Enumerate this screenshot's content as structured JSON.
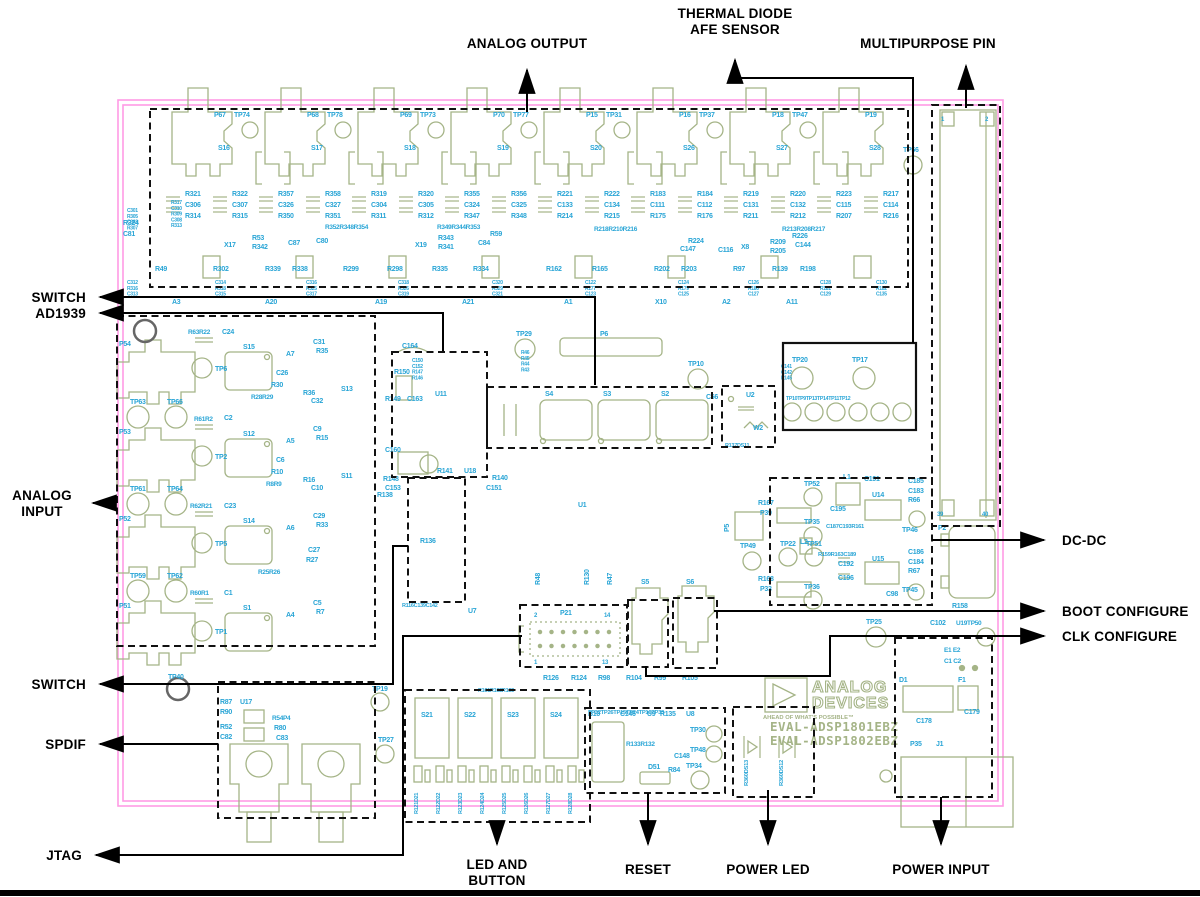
{
  "callouts": {
    "analog_output": "ANALOG OUTPUT",
    "thermal_line1": "THERMAL DIODE",
    "thermal_line2": "AFE SENSOR",
    "multipurpose_pin": "MULTIPURPOSE PIN",
    "switch_top": "SWITCH",
    "ad1939": "AD1939",
    "analog_input_line1": "ANALOG",
    "analog_input_line2": "INPUT",
    "switch_mid": "SWITCH",
    "spdif": "SPDIF",
    "jtag": "JTAG",
    "dcdc": "DC-DC",
    "boot_configure": "BOOT CONFIGURE",
    "clk_configure": "CLK CONFIGURE",
    "led_button_line1": "LED AND",
    "led_button_line2": "BUTTON",
    "reset": "RESET",
    "power_led": "POWER LED",
    "power_input": "POWER INPUT"
  },
  "logo": {
    "line1": "ANALOG",
    "line2": "DEVICES",
    "tagline": "AHEAD OF WHAT'S POSSIBLE™",
    "eval1": "EVAL-ADSP1801EBZ",
    "eval2": "EVAL-ADSP1802EBZ"
  },
  "colors": {
    "board_outline": "#ff9be5",
    "silkscreen": "#a5b487",
    "designator": "#29a5d6",
    "callout": "#000000",
    "mount_hole": "#666666"
  },
  "board": {
    "columns": {
      "x0": 185,
      "dx": 46.5,
      "rows": [
        196,
        207,
        218
      ],
      "sets": [
        [
          "R321",
          "C306",
          "R314"
        ],
        [
          "R322",
          "C307",
          "R315"
        ],
        [
          "R357",
          "C326",
          "R350"
        ],
        [
          "R358",
          "C327",
          "R351"
        ],
        [
          "R319",
          "C304",
          "R311"
        ],
        [
          "R320",
          "C305",
          "R312"
        ],
        [
          "R355",
          "C324",
          "R347"
        ],
        [
          "R356",
          "C325",
          "R348"
        ],
        [
          "R221",
          "C133",
          "R214"
        ],
        [
          "R222",
          "C134",
          "R215"
        ],
        [
          "R183",
          "C111",
          "R175"
        ],
        [
          "R184",
          "C112",
          "R176"
        ],
        [
          "R219",
          "C131",
          "R211"
        ],
        [
          "R220",
          "C132",
          "R212"
        ],
        [
          "R223",
          "C115",
          "R207"
        ],
        [
          "R217",
          "C114",
          "R216"
        ]
      ]
    },
    "top_jacks": {
      "p": [
        "P67",
        "P68",
        "P69",
        "P70",
        "P15",
        "P16",
        "P18",
        "P19"
      ],
      "tp": [
        "TP74",
        "TP78",
        "TP73",
        "TP77",
        "TP31",
        "TP37",
        "TP47"
      ],
      "s": [
        "S16",
        "S17",
        "S18",
        "S19",
        "S20",
        "S26",
        "S27",
        "S28"
      ]
    },
    "labels": [
      [
        123,
        225,
        "R324"
      ],
      [
        123,
        236,
        "C81"
      ],
      [
        224,
        247,
        "X17"
      ],
      [
        415,
        247,
        "X19"
      ],
      [
        741,
        249,
        "X8"
      ],
      [
        325,
        229,
        "R352R348R354",
        6.5
      ],
      [
        437,
        229,
        "R349R344R353",
        6.5
      ],
      [
        594,
        231,
        "R218R210R216",
        6.5
      ],
      [
        782,
        231,
        "R213R208R217",
        6.5
      ],
      [
        252,
        240,
        "R53"
      ],
      [
        252,
        249,
        "R342"
      ],
      [
        288,
        245,
        "C87"
      ],
      [
        316,
        243,
        "C80"
      ],
      [
        438,
        240,
        "R343"
      ],
      [
        438,
        249,
        "R341"
      ],
      [
        478,
        245,
        "C84"
      ],
      [
        490,
        236,
        "R59"
      ],
      [
        688,
        243,
        "R224"
      ],
      [
        680,
        251,
        "C147"
      ],
      [
        718,
        252,
        "C116"
      ],
      [
        770,
        244,
        "R209"
      ],
      [
        770,
        253,
        "R205"
      ],
      [
        795,
        247,
        "C144"
      ],
      [
        792,
        238,
        "R226"
      ],
      [
        155,
        271,
        "R49"
      ],
      [
        213,
        271,
        "R302"
      ],
      [
        265,
        271,
        "R339"
      ],
      [
        292,
        271,
        "R338"
      ],
      [
        343,
        271,
        "R299"
      ],
      [
        387,
        271,
        "R298"
      ],
      [
        432,
        271,
        "R335"
      ],
      [
        473,
        271,
        "R334"
      ],
      [
        546,
        271,
        "R162"
      ],
      [
        592,
        271,
        "R165"
      ],
      [
        654,
        271,
        "R202"
      ],
      [
        681,
        271,
        "R203"
      ],
      [
        733,
        271,
        "R97"
      ],
      [
        772,
        271,
        "R139"
      ],
      [
        800,
        271,
        "R198"
      ],
      [
        172,
        304,
        "A3"
      ],
      [
        265,
        304,
        "A20"
      ],
      [
        375,
        304,
        "A19"
      ],
      [
        462,
        304,
        "A21"
      ],
      [
        564,
        304,
        "A1"
      ],
      [
        655,
        304,
        "X10"
      ],
      [
        722,
        304,
        "A2"
      ],
      [
        786,
        304,
        "A11"
      ],
      [
        188,
        334,
        "R63R22",
        6.5
      ],
      [
        222,
        334,
        "C24"
      ],
      [
        119,
        346,
        "P54"
      ],
      [
        215,
        371,
        "TP6"
      ],
      [
        243,
        349,
        "S15"
      ],
      [
        286,
        356,
        "A7"
      ],
      [
        313,
        344,
        "C31"
      ],
      [
        316,
        353,
        "R35"
      ],
      [
        276,
        375,
        "C26"
      ],
      [
        271,
        387,
        "R30"
      ],
      [
        251,
        399,
        "R28R29",
        6.5
      ],
      [
        303,
        395,
        "R36"
      ],
      [
        311,
        403,
        "C32"
      ],
      [
        341,
        391,
        "S13"
      ],
      [
        194,
        421,
        "R61R2",
        6.5
      ],
      [
        224,
        420,
        "C2"
      ],
      [
        119,
        434,
        "P53"
      ],
      [
        215,
        459,
        "TP2"
      ],
      [
        243,
        436,
        "S12"
      ],
      [
        286,
        443,
        "A5"
      ],
      [
        313,
        431,
        "C9"
      ],
      [
        316,
        440,
        "R15"
      ],
      [
        276,
        462,
        "C6"
      ],
      [
        271,
        474,
        "R10"
      ],
      [
        266,
        486,
        "R8R9",
        6.5
      ],
      [
        303,
        482,
        "R16"
      ],
      [
        311,
        490,
        "C10"
      ],
      [
        341,
        478,
        "S11"
      ],
      [
        190,
        508,
        "R62R21",
        6.5
      ],
      [
        224,
        508,
        "C23"
      ],
      [
        119,
        521,
        "P52"
      ],
      [
        215,
        546,
        "TP5"
      ],
      [
        243,
        523,
        "S14"
      ],
      [
        286,
        530,
        "A6"
      ],
      [
        313,
        518,
        "C29"
      ],
      [
        316,
        527,
        "R33"
      ],
      [
        308,
        552,
        "C27"
      ],
      [
        306,
        562,
        "R27"
      ],
      [
        258,
        574,
        "R25R26",
        6.5
      ],
      [
        190,
        595,
        "R60R1",
        6.5
      ],
      [
        224,
        595,
        "C1"
      ],
      [
        119,
        608,
        "P51"
      ],
      [
        215,
        634,
        "TP1"
      ],
      [
        243,
        610,
        "S1"
      ],
      [
        286,
        617,
        "A4"
      ],
      [
        313,
        605,
        "C5"
      ],
      [
        316,
        614,
        "R7"
      ],
      [
        130,
        404,
        "TP63"
      ],
      [
        167,
        404,
        "TP66"
      ],
      [
        130,
        491,
        "TP61"
      ],
      [
        167,
        491,
        "TP64"
      ],
      [
        130,
        578,
        "TP59"
      ],
      [
        167,
        578,
        "TP62"
      ],
      [
        168,
        679,
        "TP40"
      ],
      [
        516,
        336,
        "TP29"
      ],
      [
        600,
        336,
        "P6"
      ],
      [
        578,
        507,
        "U1"
      ],
      [
        492,
        480,
        "R140"
      ],
      [
        486,
        490,
        "C151"
      ],
      [
        688,
        366,
        "TP10"
      ],
      [
        903,
        152,
        "TP56"
      ],
      [
        941,
        121,
        "1",
        6
      ],
      [
        985,
        121,
        "2",
        6
      ],
      [
        937,
        516,
        "39",
        6
      ],
      [
        982,
        516,
        "40",
        6
      ],
      [
        938,
        530,
        "P2"
      ],
      [
        402,
        348,
        "C164"
      ],
      [
        435,
        396,
        "U11"
      ],
      [
        394,
        374,
        "R150"
      ],
      [
        385,
        401,
        "R149"
      ],
      [
        407,
        401,
        "C163"
      ],
      [
        385,
        452,
        "C160"
      ],
      [
        383,
        481,
        "R148"
      ],
      [
        385,
        490,
        "C153"
      ],
      [
        437,
        473,
        "R141"
      ],
      [
        464,
        473,
        "U18"
      ],
      [
        377,
        497,
        "R138"
      ],
      [
        545,
        396,
        "S4"
      ],
      [
        603,
        396,
        "S3"
      ],
      [
        661,
        396,
        "S2"
      ],
      [
        706,
        399,
        "C56"
      ],
      [
        746,
        397,
        "U2"
      ],
      [
        753,
        430,
        "W2"
      ],
      [
        725,
        447,
        "R137DS11",
        5.5
      ],
      [
        420,
        543,
        "R136"
      ],
      [
        402,
        607,
        "R116C139C142",
        5.5
      ],
      [
        468,
        613,
        "U7"
      ],
      [
        543,
        680,
        "R126"
      ],
      [
        571,
        680,
        "R124"
      ],
      [
        598,
        680,
        "R98"
      ],
      [
        626,
        680,
        "R104"
      ],
      [
        654,
        680,
        "R99"
      ],
      [
        682,
        680,
        "R105"
      ],
      [
        478,
        692,
        "R101R102R103",
        5.5
      ],
      [
        588,
        714,
        "TP32TP26TP15TP24TP16TP33",
        5.8
      ],
      [
        540,
        585,
        "R48",
        7,
        "v"
      ],
      [
        589,
        585,
        "R130",
        7,
        "v"
      ],
      [
        612,
        585,
        "R47",
        7,
        "v"
      ],
      [
        534,
        617,
        "2",
        6
      ],
      [
        560,
        615,
        "P21"
      ],
      [
        604,
        617,
        "14",
        6
      ],
      [
        534,
        664,
        "1",
        6
      ],
      [
        602,
        664,
        "13",
        6
      ],
      [
        641,
        584,
        "S5"
      ],
      [
        686,
        584,
        "S6"
      ],
      [
        588,
        716,
        "B10"
      ],
      [
        620,
        716,
        "C146"
      ],
      [
        647,
        716,
        "U9"
      ],
      [
        660,
        716,
        "R135"
      ],
      [
        686,
        716,
        "U8"
      ],
      [
        690,
        732,
        "TP30"
      ],
      [
        690,
        752,
        "TP48"
      ],
      [
        626,
        746,
        "R133R132",
        6.5
      ],
      [
        674,
        758,
        "C148"
      ],
      [
        686,
        768,
        "TP34"
      ],
      [
        648,
        769,
        "D51"
      ],
      [
        668,
        772,
        "R84"
      ],
      [
        748,
        786,
        "R360DS13",
        5.8,
        "v"
      ],
      [
        783,
        786,
        "R360DS12",
        5.8,
        "v"
      ],
      [
        421,
        717,
        "S21"
      ],
      [
        464,
        717,
        "S22"
      ],
      [
        507,
        717,
        "S23"
      ],
      [
        550,
        717,
        "S24"
      ],
      [
        418,
        814,
        "R121D21",
        5.5,
        "v"
      ],
      [
        440,
        814,
        "R122D22",
        5.5,
        "v"
      ],
      [
        462,
        814,
        "R123D23",
        5.5,
        "v"
      ],
      [
        484,
        814,
        "R124D24",
        5.5,
        "v"
      ],
      [
        506,
        814,
        "R125D25",
        5.5,
        "v"
      ],
      [
        528,
        814,
        "R126D26",
        5.5,
        "v"
      ],
      [
        550,
        814,
        "R127D27",
        5.5,
        "v"
      ],
      [
        572,
        814,
        "R128D28",
        5.5,
        "v"
      ],
      [
        220,
        704,
        "R87"
      ],
      [
        240,
        704,
        "U17"
      ],
      [
        220,
        714,
        "R90"
      ],
      [
        220,
        729,
        "R52"
      ],
      [
        220,
        739,
        "C82"
      ],
      [
        272,
        720,
        "R54P4",
        6.5
      ],
      [
        274,
        730,
        "R80"
      ],
      [
        276,
        740,
        "C83"
      ],
      [
        378,
        742,
        "TP27"
      ],
      [
        372,
        691,
        "TP19"
      ],
      [
        843,
        479,
        "L1"
      ],
      [
        864,
        481,
        "C191"
      ],
      [
        804,
        486,
        "TP52"
      ],
      [
        758,
        505,
        "R167"
      ],
      [
        760,
        515,
        "P39"
      ],
      [
        830,
        511,
        "C195"
      ],
      [
        872,
        497,
        "U14"
      ],
      [
        908,
        483,
        "C185"
      ],
      [
        908,
        493,
        "C183"
      ],
      [
        908,
        502,
        "R66"
      ],
      [
        826,
        528,
        "C187C193R161",
        5.8
      ],
      [
        804,
        524,
        "TP35"
      ],
      [
        780,
        546,
        "TP22"
      ],
      [
        806,
        546,
        "TP51"
      ],
      [
        800,
        544,
        "L2"
      ],
      [
        818,
        556,
        "R159R163C189",
        5.8
      ],
      [
        838,
        566,
        "C192"
      ],
      [
        838,
        580,
        "C196"
      ],
      [
        872,
        561,
        "U15"
      ],
      [
        908,
        554,
        "C186"
      ],
      [
        908,
        564,
        "C184"
      ],
      [
        908,
        573,
        "R67"
      ],
      [
        886,
        596,
        "C98"
      ],
      [
        902,
        532,
        "TP46"
      ],
      [
        902,
        592,
        "TP45"
      ],
      [
        758,
        581,
        "R168"
      ],
      [
        760,
        591,
        "P33"
      ],
      [
        804,
        589,
        "TP36"
      ],
      [
        866,
        624,
        "TP25"
      ],
      [
        952,
        608,
        "R158"
      ],
      [
        930,
        625,
        "C102"
      ],
      [
        956,
        625,
        "U19TP50",
        6.5
      ],
      [
        729,
        532,
        "P5",
        7,
        "v"
      ],
      [
        740,
        548,
        "TP49"
      ],
      [
        944,
        652,
        "E1 E2",
        6.5
      ],
      [
        944,
        663,
        "C1 C2",
        6.5
      ],
      [
        899,
        682,
        "D1"
      ],
      [
        958,
        682,
        "F1"
      ],
      [
        916,
        723,
        "C178"
      ],
      [
        964,
        714,
        "C179"
      ],
      [
        910,
        746,
        "P35"
      ],
      [
        936,
        746,
        "J1"
      ],
      [
        792,
        362,
        "TP20"
      ],
      [
        852,
        362,
        "TP17"
      ],
      [
        786,
        400,
        "TP10TP9TP13TP14TP11TP12",
        5.2
      ]
    ],
    "stacks": [
      {
        "x": 127,
        "y": 212,
        "s": 5,
        "l": [
          "C301",
          "R305",
          "C303",
          "R307"
        ]
      },
      {
        "x": 171,
        "y": 204,
        "s": 5,
        "l": [
          "R317",
          "C310",
          "R309",
          "C308",
          "R313"
        ]
      },
      {
        "x": 412,
        "y": 362,
        "s": 5,
        "l": [
          "C150",
          "C152",
          "R147",
          "R146"
        ]
      },
      {
        "x": 521,
        "y": 354,
        "s": 5,
        "l": [
          "R46",
          "R45",
          "R44",
          "R43"
        ]
      },
      {
        "x": 781,
        "y": 368,
        "s": 5,
        "l": [
          "C141",
          "C142",
          "R145"
        ]
      },
      {
        "x": 127,
        "y": 284,
        "s": 5,
        "l": [
          "C312",
          "R316",
          "C313"
        ]
      },
      {
        "x": 215,
        "y": 284,
        "s": 5,
        "l": [
          "C314",
          "R318",
          "C315"
        ]
      },
      {
        "x": 306,
        "y": 284,
        "s": 5,
        "l": [
          "C316",
          "R325",
          "C317"
        ]
      },
      {
        "x": 398,
        "y": 284,
        "s": 5,
        "l": [
          "C318",
          "R326",
          "C319"
        ]
      },
      {
        "x": 492,
        "y": 284,
        "s": 5,
        "l": [
          "C320",
          "R329",
          "C321"
        ]
      },
      {
        "x": 585,
        "y": 284,
        "s": 5,
        "l": [
          "C122",
          "R177",
          "C123"
        ]
      },
      {
        "x": 678,
        "y": 284,
        "s": 5,
        "l": [
          "C124",
          "R179",
          "C125"
        ]
      },
      {
        "x": 748,
        "y": 284,
        "s": 5,
        "l": [
          "C126",
          "R180",
          "C127"
        ]
      },
      {
        "x": 820,
        "y": 284,
        "s": 5,
        "l": [
          "C128",
          "R181",
          "C129"
        ]
      },
      {
        "x": 876,
        "y": 284,
        "s": 5,
        "l": [
          "C130",
          "R182",
          "C135"
        ]
      }
    ]
  }
}
